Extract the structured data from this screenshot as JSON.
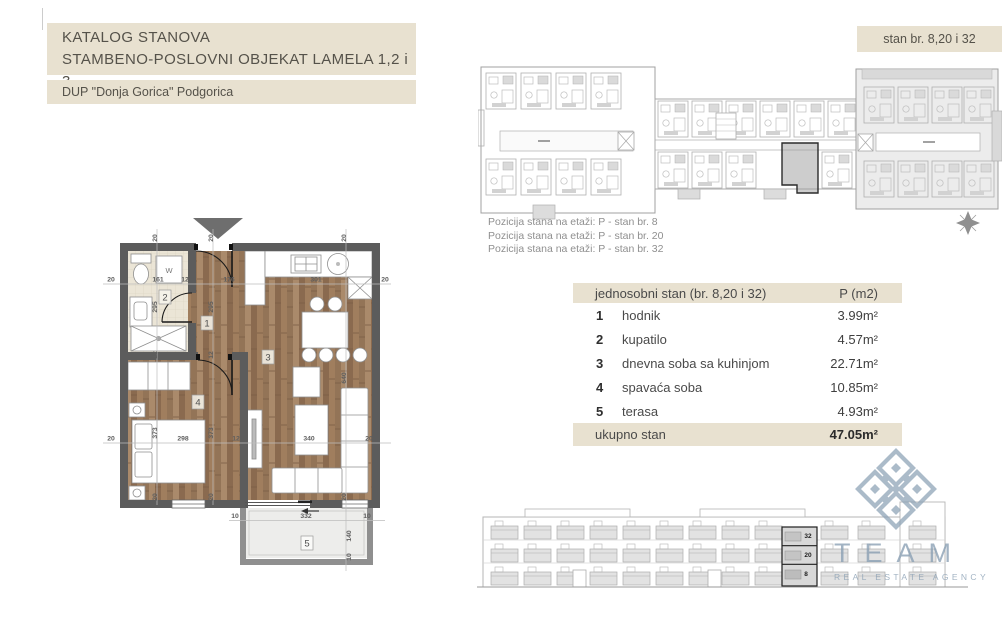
{
  "page": {
    "title_line1": "KATALOG STANOVA",
    "title_line2": "STAMBENO-POSLOVNI OBJEKAT LAMELA 1,2 i 3",
    "subtitle": "DUP \"Donja Gorica\" Podgorica",
    "stan_badge": "stan br. 8,20 i 32"
  },
  "position_info": {
    "line1": "Pozicija stana na etaži: P - stan br. 8",
    "line2": "Pozicija stana na etaži: P - stan br. 20",
    "line3": "Pozicija stana na etaži: P - stan br. 32"
  },
  "area_table": {
    "header_name": "jednosobni stan (br. 8,20 i 32)",
    "header_area": "P (m2)",
    "rows": [
      {
        "num": "1",
        "name": "hodnik",
        "area": "3.99m²"
      },
      {
        "num": "2",
        "name": "kupatilo",
        "area": "4.57m²"
      },
      {
        "num": "3",
        "name": "dnevna soba sa kuhinjom",
        "area": "22.71m²"
      },
      {
        "num": "4",
        "name": "spavaća soba",
        "area": "10.85m²"
      },
      {
        "num": "5",
        "name": "terasa",
        "area": "4.93m²"
      }
    ],
    "total_name": "ukupno stan",
    "total_area": "47.05m²"
  },
  "floor_plan": {
    "room_labels": [
      "1",
      "2",
      "3",
      "4",
      "5"
    ],
    "washer_label": "W",
    "dims": {
      "top_edge": [
        "20",
        "20",
        "20"
      ],
      "row1": [
        "20",
        "161",
        "12",
        "176",
        "301",
        "20"
      ],
      "col_a": [
        "295",
        "12",
        "373",
        "20"
      ],
      "col_b": [
        "295",
        "12",
        "373",
        "20"
      ],
      "row2": [
        "20",
        "298",
        "12",
        "340",
        "20"
      ],
      "col_c": [
        "640",
        "20"
      ],
      "terrace_row": [
        "10",
        "332",
        "10"
      ],
      "terrace_col": [
        "140",
        "10"
      ]
    }
  },
  "elevation": {
    "unit_labels": [
      "32",
      "20",
      "8"
    ]
  },
  "watermark": {
    "name": "TEAM",
    "tagline": "REAL ESTATE AGENCY"
  },
  "colors": {
    "beige": "#e8e1d0",
    "wall_gray": "#5c5c5c",
    "wood_brown": "#9d7f63",
    "drawing_gray": "#a8a8a8",
    "watermark_blue": "#8ba1b5"
  }
}
